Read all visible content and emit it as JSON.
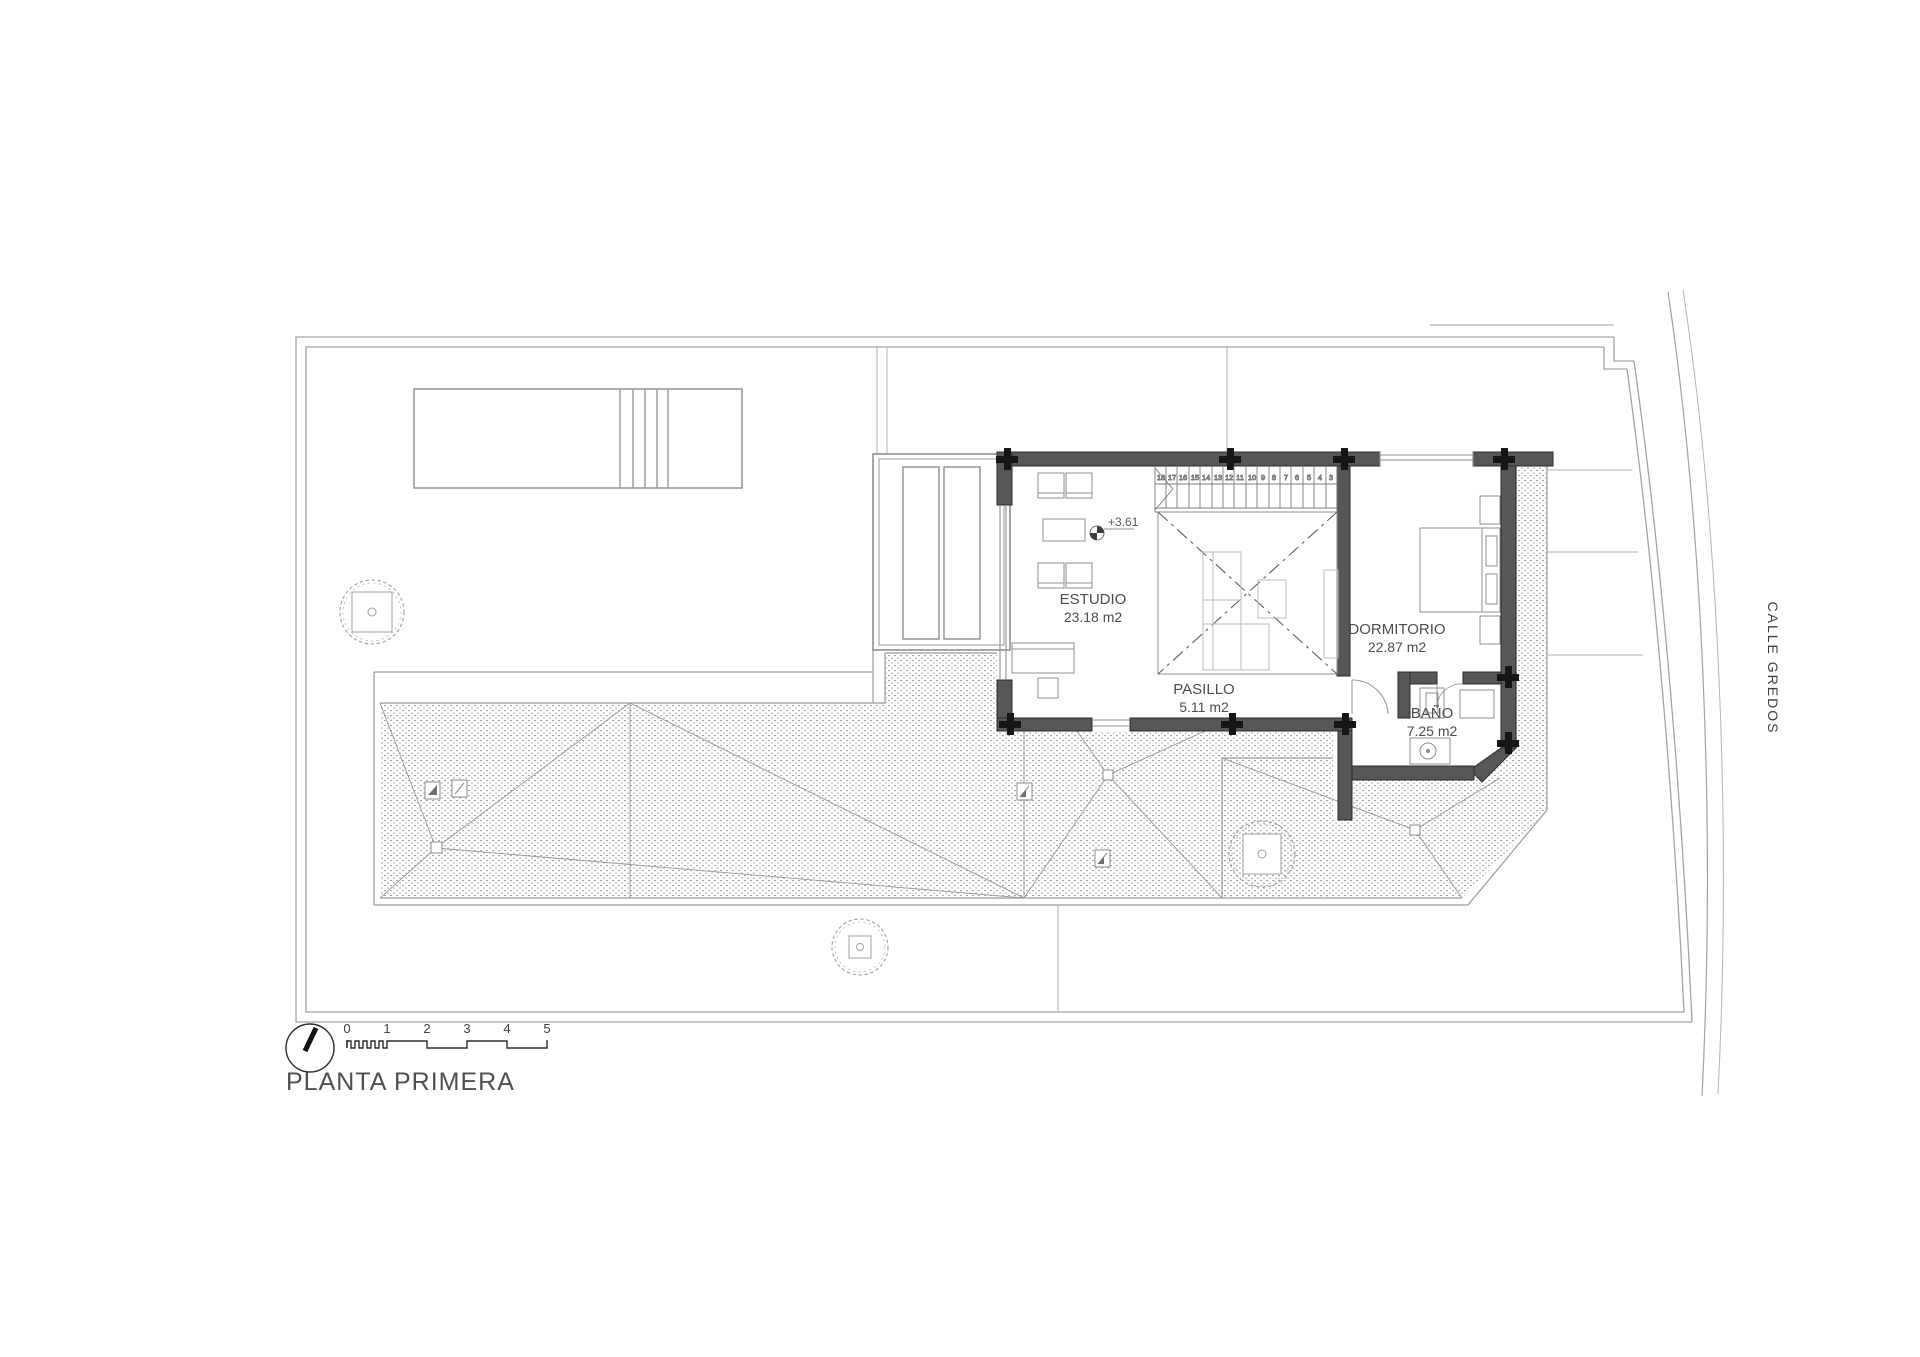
{
  "plan": {
    "title": "PLANTA PRIMERA",
    "street_name": "CALLE GREDOS",
    "level_marker": "+3.61",
    "rooms": {
      "estudio": {
        "name": "ESTUDIO",
        "area": "23.18 m2"
      },
      "dormitorio": {
        "name": "DORMITORIO",
        "area": "22.87 m2"
      },
      "pasillo": {
        "name": "PASILLO",
        "area": "5.11 m2"
      },
      "bano": {
        "name": "BAÑO",
        "area": "7.25 m2"
      }
    },
    "stairs": {
      "step_numbers": [
        "18",
        "17",
        "16",
        "15",
        "14",
        "13",
        "12",
        "11",
        "10",
        "9",
        "8",
        "7",
        "6",
        "5",
        "4",
        "3"
      ]
    },
    "scale_bar": {
      "tick_labels": [
        "0",
        "1",
        "2",
        "3",
        "4",
        "5"
      ]
    },
    "colors": {
      "wall_fill": "#575757",
      "column_fill": "#161616",
      "thin_line": "#8f8f8f",
      "boundary_line": "#a3a3a3",
      "hatch_dot": "#a6a6a6",
      "ghost_furniture": "#bdbdbd",
      "text": "#4d4d4d"
    }
  }
}
